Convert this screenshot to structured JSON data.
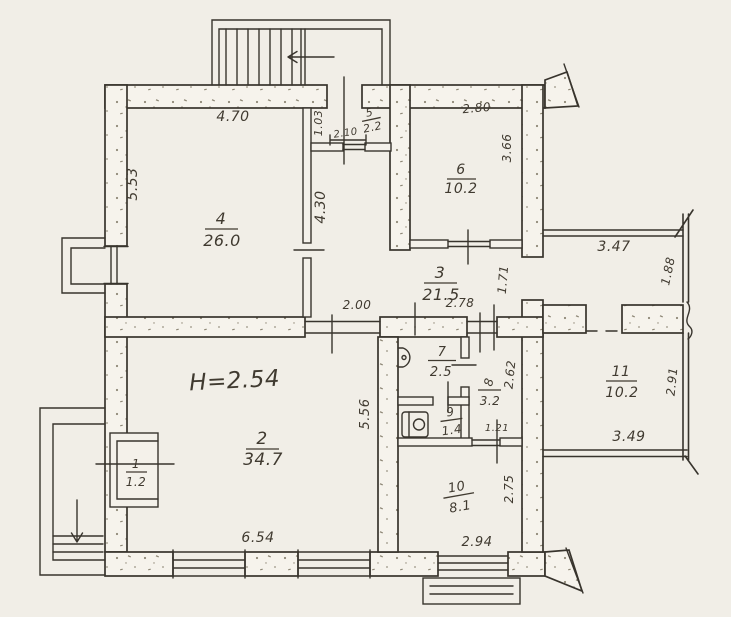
{
  "plan": {
    "note": {
      "ceiling_height": "H=2.54"
    },
    "rooms": [
      {
        "number": "1",
        "area": "1.2"
      },
      {
        "number": "2",
        "area": "34.7"
      },
      {
        "number": "3",
        "area": "21.5"
      },
      {
        "number": "4",
        "area": "26.0"
      },
      {
        "number": "5",
        "area": "2.2"
      },
      {
        "number": "6",
        "area": "10.2"
      },
      {
        "number": "7",
        "area": "2.5"
      },
      {
        "number": "8",
        "area": "3.2"
      },
      {
        "number": "9",
        "area": "1.4"
      },
      {
        "number": "10",
        "area": "8.1"
      },
      {
        "number": "11",
        "area": "10.2"
      }
    ],
    "dims": {
      "room4_width": "4.70",
      "room4_depth": "5.53",
      "hall_depth": "4.30",
      "room5_depth": "1.03",
      "room5_width": "2.10",
      "room6_width": "2.80",
      "room6_depth": "3.66",
      "terrace_width": "3.47",
      "terrace_depth": "1.88",
      "hall_gap": "1.71",
      "room2_door": "2.00",
      "hall_width": "2.78",
      "room2_width": "6.54",
      "room2_depth": "5.56",
      "room8_depth": "2.62",
      "room8_width": "1.21",
      "room11_width": "3.49",
      "room11_depth": "2.91",
      "room10_width": "2.94",
      "room10_depth": "2.75"
    },
    "colors": {
      "paper": "#f1eee7",
      "ink": "#38342d",
      "wall_fill": "#f6f3ec",
      "speckle": "#8f8877"
    }
  }
}
